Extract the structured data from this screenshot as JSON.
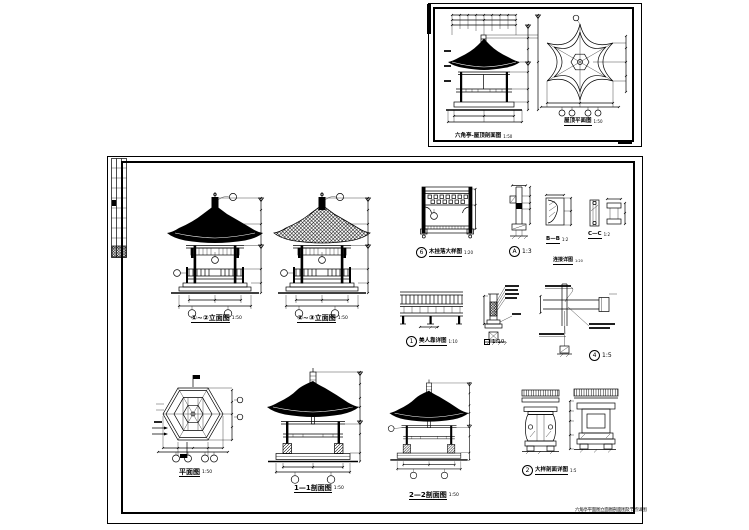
{
  "captions": {
    "top_left": {
      "title": "六角亭-屋顶剖面图",
      "scale": "1:50"
    },
    "top_right": {
      "title": "屋顶平面图",
      "scale": "1:50"
    },
    "elev1": {
      "title": "①~②立面图",
      "scale": "1:50"
    },
    "elev2": {
      "title": "②~③立面图",
      "scale": "1:50"
    },
    "lattice": {
      "num": "6",
      "title": "木挂落大样图",
      "scale": "1:20"
    },
    "detail_a": {
      "num": "A",
      "scale": "1:3"
    },
    "bb": {
      "title": "B—B",
      "scale": "1:2"
    },
    "cc": {
      "title": "C—C",
      "scale": "1:2"
    },
    "conn": {
      "title": "连接详图",
      "scale": "1:20"
    },
    "bench": {
      "num": "1",
      "title": "美人靠详图",
      "scale": "1:10"
    },
    "col_base": {
      "scale": "1:10"
    },
    "eave": {
      "num": "4",
      "scale": "1:5"
    },
    "plan": {
      "title": "平面图",
      "scale": "1:50"
    },
    "sec1": {
      "title": "1—1剖面图",
      "scale": "1:50"
    },
    "sec2": {
      "title": "2—2剖面图",
      "scale": "1:50"
    },
    "pedestal": {
      "num": "2",
      "title": "大样剖面详图",
      "scale": "1:5"
    },
    "sheet_note": "六角亭平面图立面图剖面图及节点详图"
  }
}
